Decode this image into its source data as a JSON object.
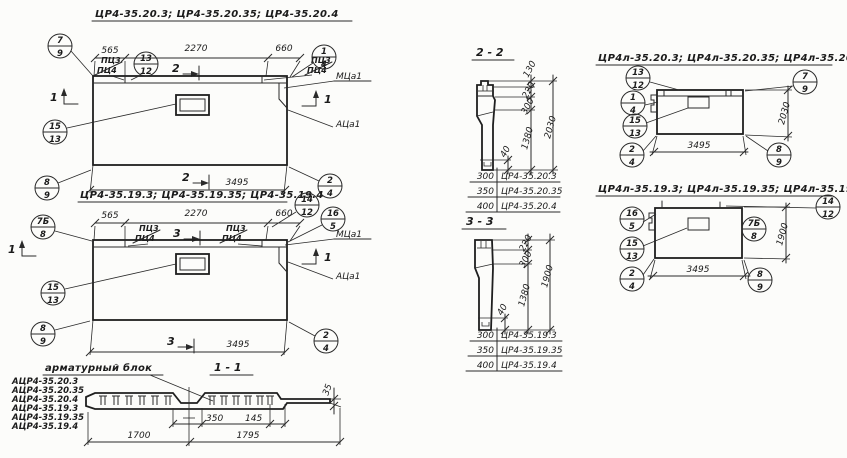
{
  "panel_20": {
    "title": "ЦР4-35.20.3; ЦР4-35.20.35; ЦР4-35.20.4",
    "dim_a": "565",
    "dim_b": "2270",
    "dim_c": "660",
    "dim_total": "3495",
    "tag_top": "ПЦ3",
    "tag_bot": "ПЦ4",
    "cut_label": "2",
    "side_cut_label": "1",
    "loop_label": "МЦа1",
    "anchor_label": "АЦа1",
    "callouts": {
      "k7_9": {
        "top": "7",
        "bot": "9"
      },
      "k13_12": {
        "top": "13",
        "bot": "12"
      },
      "k1_4": {
        "top": "1",
        "bot": "4"
      },
      "k15_13": {
        "top": "15",
        "bot": "13"
      },
      "k8_9": {
        "top": "8",
        "bot": "9"
      },
      "k2_4": {
        "top": "2",
        "bot": "4"
      }
    }
  },
  "panel_19": {
    "title": "ЦР4-35.19.3; ЦР4-35.19.35; ЦР4-35.19.4",
    "dim_a": "565",
    "dim_b": "2270",
    "dim_c": "660",
    "dim_total": "3495",
    "tag_top": "ПЦ3",
    "tag_bot": "ПЦ4",
    "cut_label": "3",
    "side_cut_label": "1",
    "loop_label": "МЦа1",
    "anchor_label": "АЦа1",
    "callouts": {
      "k7b_8": {
        "top": "7Б",
        "bot": "8"
      },
      "k14_12": {
        "top": "14",
        "bot": "12"
      },
      "k16_5": {
        "top": "16",
        "bot": "5"
      },
      "k15_13": {
        "top": "15",
        "bot": "13"
      },
      "k8_9": {
        "top": "8",
        "bot": "9"
      },
      "k2_4": {
        "top": "2",
        "bot": "4"
      }
    }
  },
  "section_2_2": {
    "title": "2 - 2",
    "dim_130": "130",
    "dim_220": "220",
    "dim_300": "300",
    "dim_1380": "1380",
    "dim_total": "2030",
    "dim_40": "40",
    "table": [
      {
        "width": "300",
        "mark": "ЦР4-35.20.3"
      },
      {
        "width": "350",
        "mark": "ЦР4-35.20.35"
      },
      {
        "width": "400",
        "mark": "ЦР4-35.20.4"
      }
    ]
  },
  "section_3_3": {
    "title": "3 - 3",
    "dim_220": "220",
    "dim_300": "300",
    "dim_1380": "1380",
    "dim_total": "1900",
    "dim_40": "40",
    "table": [
      {
        "width": "300",
        "mark": "ЦР4-35.19.3"
      },
      {
        "width": "350",
        "mark": "ЦР4-35.19.35"
      },
      {
        "width": "400",
        "mark": "ЦР4-35.19.4"
      }
    ]
  },
  "section_1_1": {
    "title": "1 - 1",
    "dim_350": "350",
    "dim_145": "145",
    "dim_1700": "1700",
    "dim_1795": "1795",
    "dim_35": "35"
  },
  "rebar_block": {
    "title": "арматурный  блок",
    "items": [
      "АЦР4-35.20.3",
      "АЦР4-35.20.35",
      "АЦР4-35.20.4",
      "АЦР4-35.19.3",
      "АЦР4-35.19.35",
      "АЦР4-35.19.4"
    ]
  },
  "panel_l20": {
    "title": "ЦР4л-35.20.3; ЦР4л-35.20.35; ЦР4л-35.20.4",
    "dim_total": "3495",
    "dim_height": "2030",
    "callouts": {
      "k13_12": {
        "top": "13",
        "bot": "12"
      },
      "k7_9": {
        "top": "7",
        "bot": "9"
      },
      "k1_4": {
        "top": "1",
        "bot": "4"
      },
      "k15_13": {
        "top": "15",
        "bot": "13"
      },
      "k2_4": {
        "top": "2",
        "bot": "4"
      },
      "k8_9": {
        "top": "8",
        "bot": "9"
      }
    }
  },
  "panel_l19": {
    "title": "ЦР4л-35.19.3; ЦР4л-35.19.35; ЦР4л-35.19.4",
    "dim_total": "3495",
    "dim_height": "1900",
    "callouts": {
      "k16_5": {
        "top": "16",
        "bot": "5"
      },
      "k14_12": {
        "top": "14",
        "bot": "12"
      },
      "k7b_8": {
        "top": "7Б",
        "bot": "8"
      },
      "k15_13": {
        "top": "15",
        "bot": "13"
      },
      "k2_4": {
        "top": "2",
        "bot": "4"
      },
      "k8_9": {
        "top": "8",
        "bot": "9"
      }
    }
  }
}
